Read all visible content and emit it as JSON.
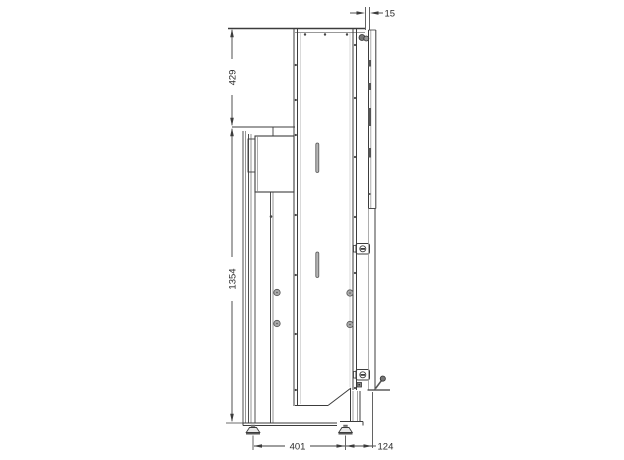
{
  "drawing": {
    "type": "technical-side-view",
    "dimensions": {
      "top_gap": "15",
      "upper_height": "429",
      "column_height": "1354",
      "base_width": "401",
      "base_offset": "124"
    },
    "parts": {
      "main_panel": "rear panel",
      "column": "lifting column",
      "wall_rail": "wall rail",
      "feet": "leveling feet"
    }
  }
}
